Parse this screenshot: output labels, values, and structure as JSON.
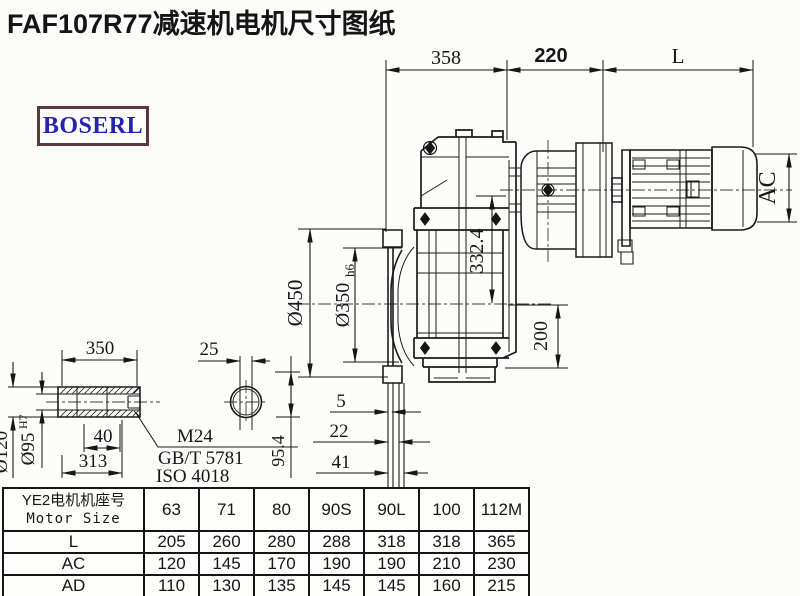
{
  "title": "FAF107R77减速机电机尺寸图纸",
  "logo": {
    "text": "BOSERL"
  },
  "dims": {
    "top_358": "358",
    "top_220": "220",
    "top_L": "L",
    "ac": "AC",
    "inner_332": "332.4",
    "right_200": "200",
    "flange_od": "Ø450",
    "flange_spigot": "Ø350",
    "flange_spigot_tol": "h6",
    "off_5": "5",
    "off_22": "22",
    "off_41": "41",
    "off_95": "95.4"
  },
  "shaft": {
    "len_350": "350",
    "key_25": "25",
    "len_40": "40",
    "len_313": "313",
    "od_120": "Ø120",
    "bore_95": "Ø95",
    "bore_tol": "H7",
    "thread": "M24",
    "std1": "GB/T 5781",
    "std2": "ISO 4018"
  },
  "table": {
    "header_cn": "YE2电机机座号",
    "header_en": "Motor Size",
    "sizes": [
      "63",
      "71",
      "80",
      "90S",
      "90L",
      "100",
      "112M"
    ],
    "rows": [
      {
        "label": "L",
        "values": [
          "205",
          "260",
          "280",
          "288",
          "318",
          "318",
          "365"
        ]
      },
      {
        "label": "AC",
        "values": [
          "120",
          "145",
          "170",
          "190",
          "190",
          "210",
          "230"
        ]
      },
      {
        "label": "AD",
        "values": [
          "110",
          "130",
          "135",
          "145",
          "145",
          "160",
          "215"
        ]
      }
    ]
  }
}
